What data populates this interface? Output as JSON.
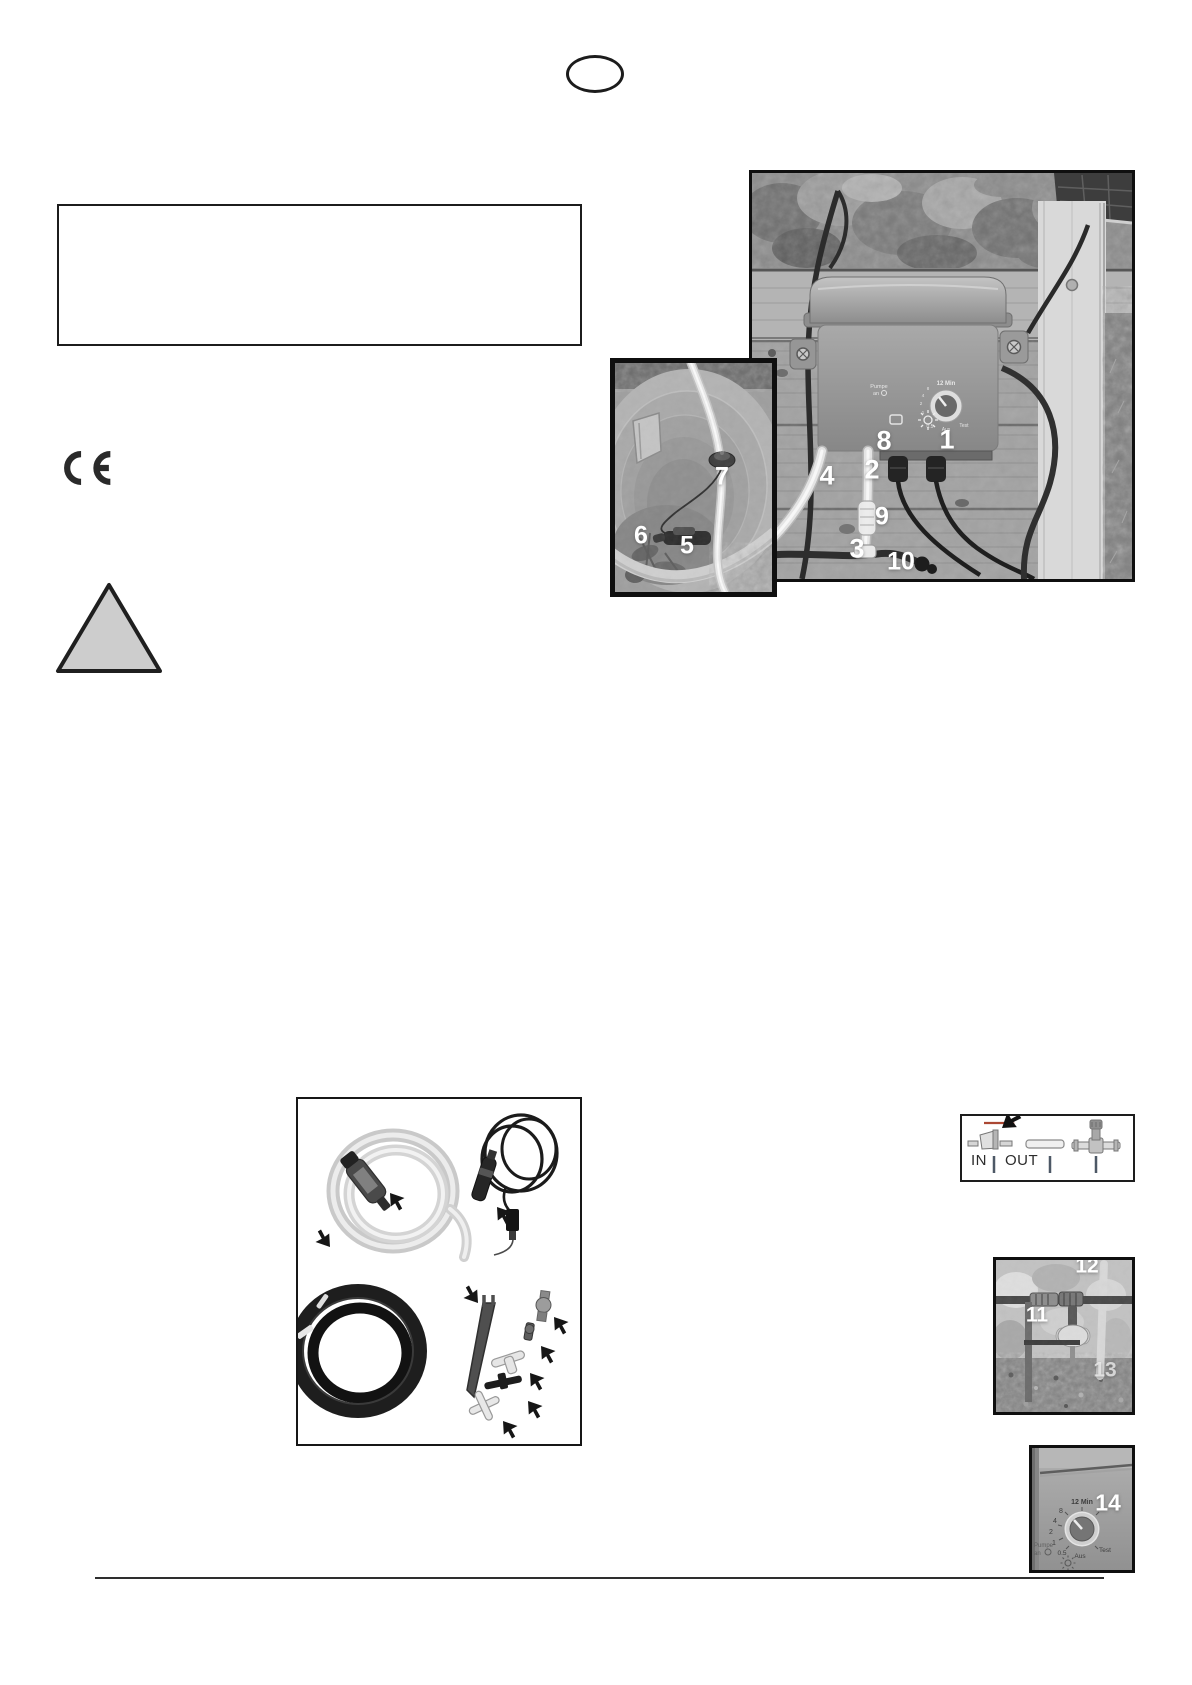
{
  "symbols": {
    "ce_mark": "CE"
  },
  "callouts": {
    "main_photo": [
      "8",
      "1",
      "4",
      "2",
      "9",
      "3",
      "10"
    ],
    "barrel_photo": [
      "7",
      "6",
      "5"
    ],
    "drip_photo": [
      "11",
      "12",
      "13"
    ],
    "dial_photo": [
      "14"
    ]
  },
  "inout_diagram": {
    "in_label": "IN",
    "out_label": "OUT"
  },
  "timer_dial": {
    "top_label": "12 Min",
    "scale_values": [
      "8",
      "4",
      "2",
      "1",
      "0.5"
    ],
    "off_label": "Aus",
    "test_label": "Test",
    "pump_line1": "Pumpe",
    "pump_line2": "an"
  },
  "colors": {
    "accent_arrow": "#ab4733",
    "callout_text": "#ffffff",
    "page_bg": "#ffffff"
  }
}
